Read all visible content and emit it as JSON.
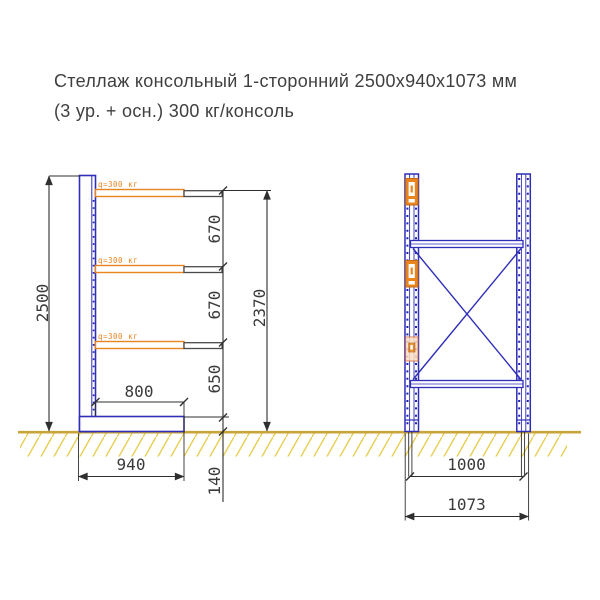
{
  "title": {
    "line1": "Стеллаж консольный 1-сторонний 2500х940х1073 мм",
    "line2": "(3 ур. + осн.) 300 кг/консоль"
  },
  "colors": {
    "frame_blue": "#2e2eb8",
    "arm_orange": "#e8851f",
    "ground_hatch_yellow": "#e7cd4e",
    "ground_line_tan": "#c9a43a",
    "dimension_dark": "#2f2f2f"
  },
  "side_view": {
    "load_label": "q=300 кг",
    "dim_total_height": "2500",
    "dim_spacing_top": "670",
    "dim_spacing_mid": "670",
    "dim_spacing_bottom": "650",
    "dim_arms_height": "2370",
    "dim_arm_length": "800",
    "dim_base_depth": "940",
    "dim_base_height": "140"
  },
  "front_view": {
    "dim_axis_spacing": "1000",
    "dim_overall_width": "1073"
  }
}
